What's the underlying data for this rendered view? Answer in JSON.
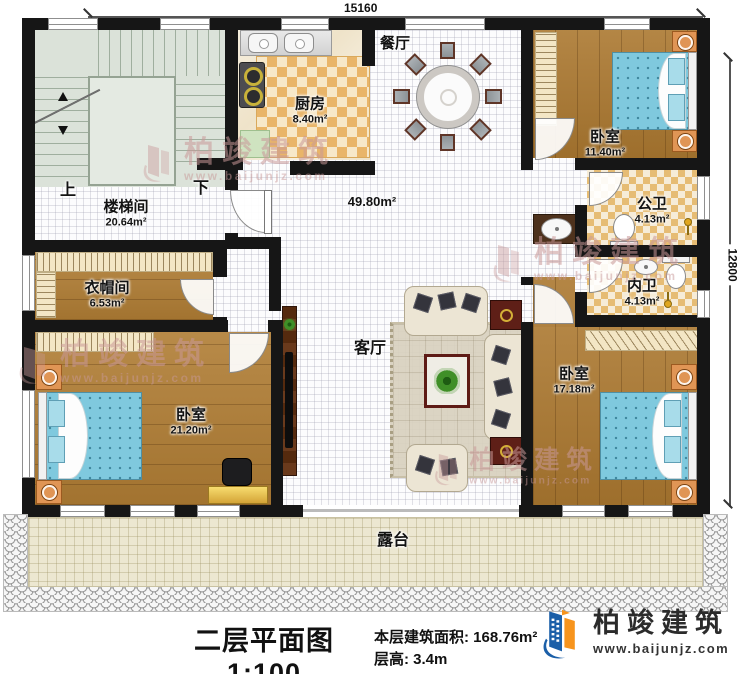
{
  "dimensions": {
    "width_mm": "15160",
    "height_mm": "12800"
  },
  "rooms": {
    "stair_hall": {
      "name": "楼梯间",
      "area": "20.64m²",
      "up_label": "上",
      "down_label": "下"
    },
    "kitchen": {
      "name": "厨房",
      "area": "8.40m²"
    },
    "dining": {
      "name": "餐厅"
    },
    "living": {
      "name": "客厅",
      "combined_area": "49.80m²"
    },
    "bedroom_top_right": {
      "name": "卧室",
      "area": "11.40m²"
    },
    "public_bathroom": {
      "name": "公卫",
      "area": "4.13m²"
    },
    "ensuite_bathroom": {
      "name": "内卫",
      "area": "4.13m²"
    },
    "cloakroom": {
      "name": "衣帽间",
      "area": "6.53m²"
    },
    "bedroom_left": {
      "name": "卧室",
      "area": "21.20m²"
    },
    "bedroom_right": {
      "name": "卧室",
      "area": "17.18m²"
    },
    "terrace": {
      "name": "露台"
    }
  },
  "title_block": {
    "title": "二层平面图1:100",
    "floor_area_label": "本层建筑面积:",
    "floor_area_value": "168.76m²",
    "floor_height_label": "层高:",
    "floor_height_value": "3.4m"
  },
  "brand": {
    "name": "柏竣建筑",
    "website": "www.baijunjz.com"
  },
  "watermark": {
    "name": "柏竣建筑",
    "website": "www.baijunjz.com"
  },
  "colors": {
    "wall": "#161616",
    "wood_floor": "#ab7830",
    "kitchen_tile": "#e9b569",
    "bath_tile": "#e6bc74",
    "stair_floor": "#dbe2d9",
    "terrace_floor": "#ece7d1",
    "bed": "#7fc9de",
    "brand_blue": "#1b5fa8",
    "brand_orange": "#f7941d"
  }
}
